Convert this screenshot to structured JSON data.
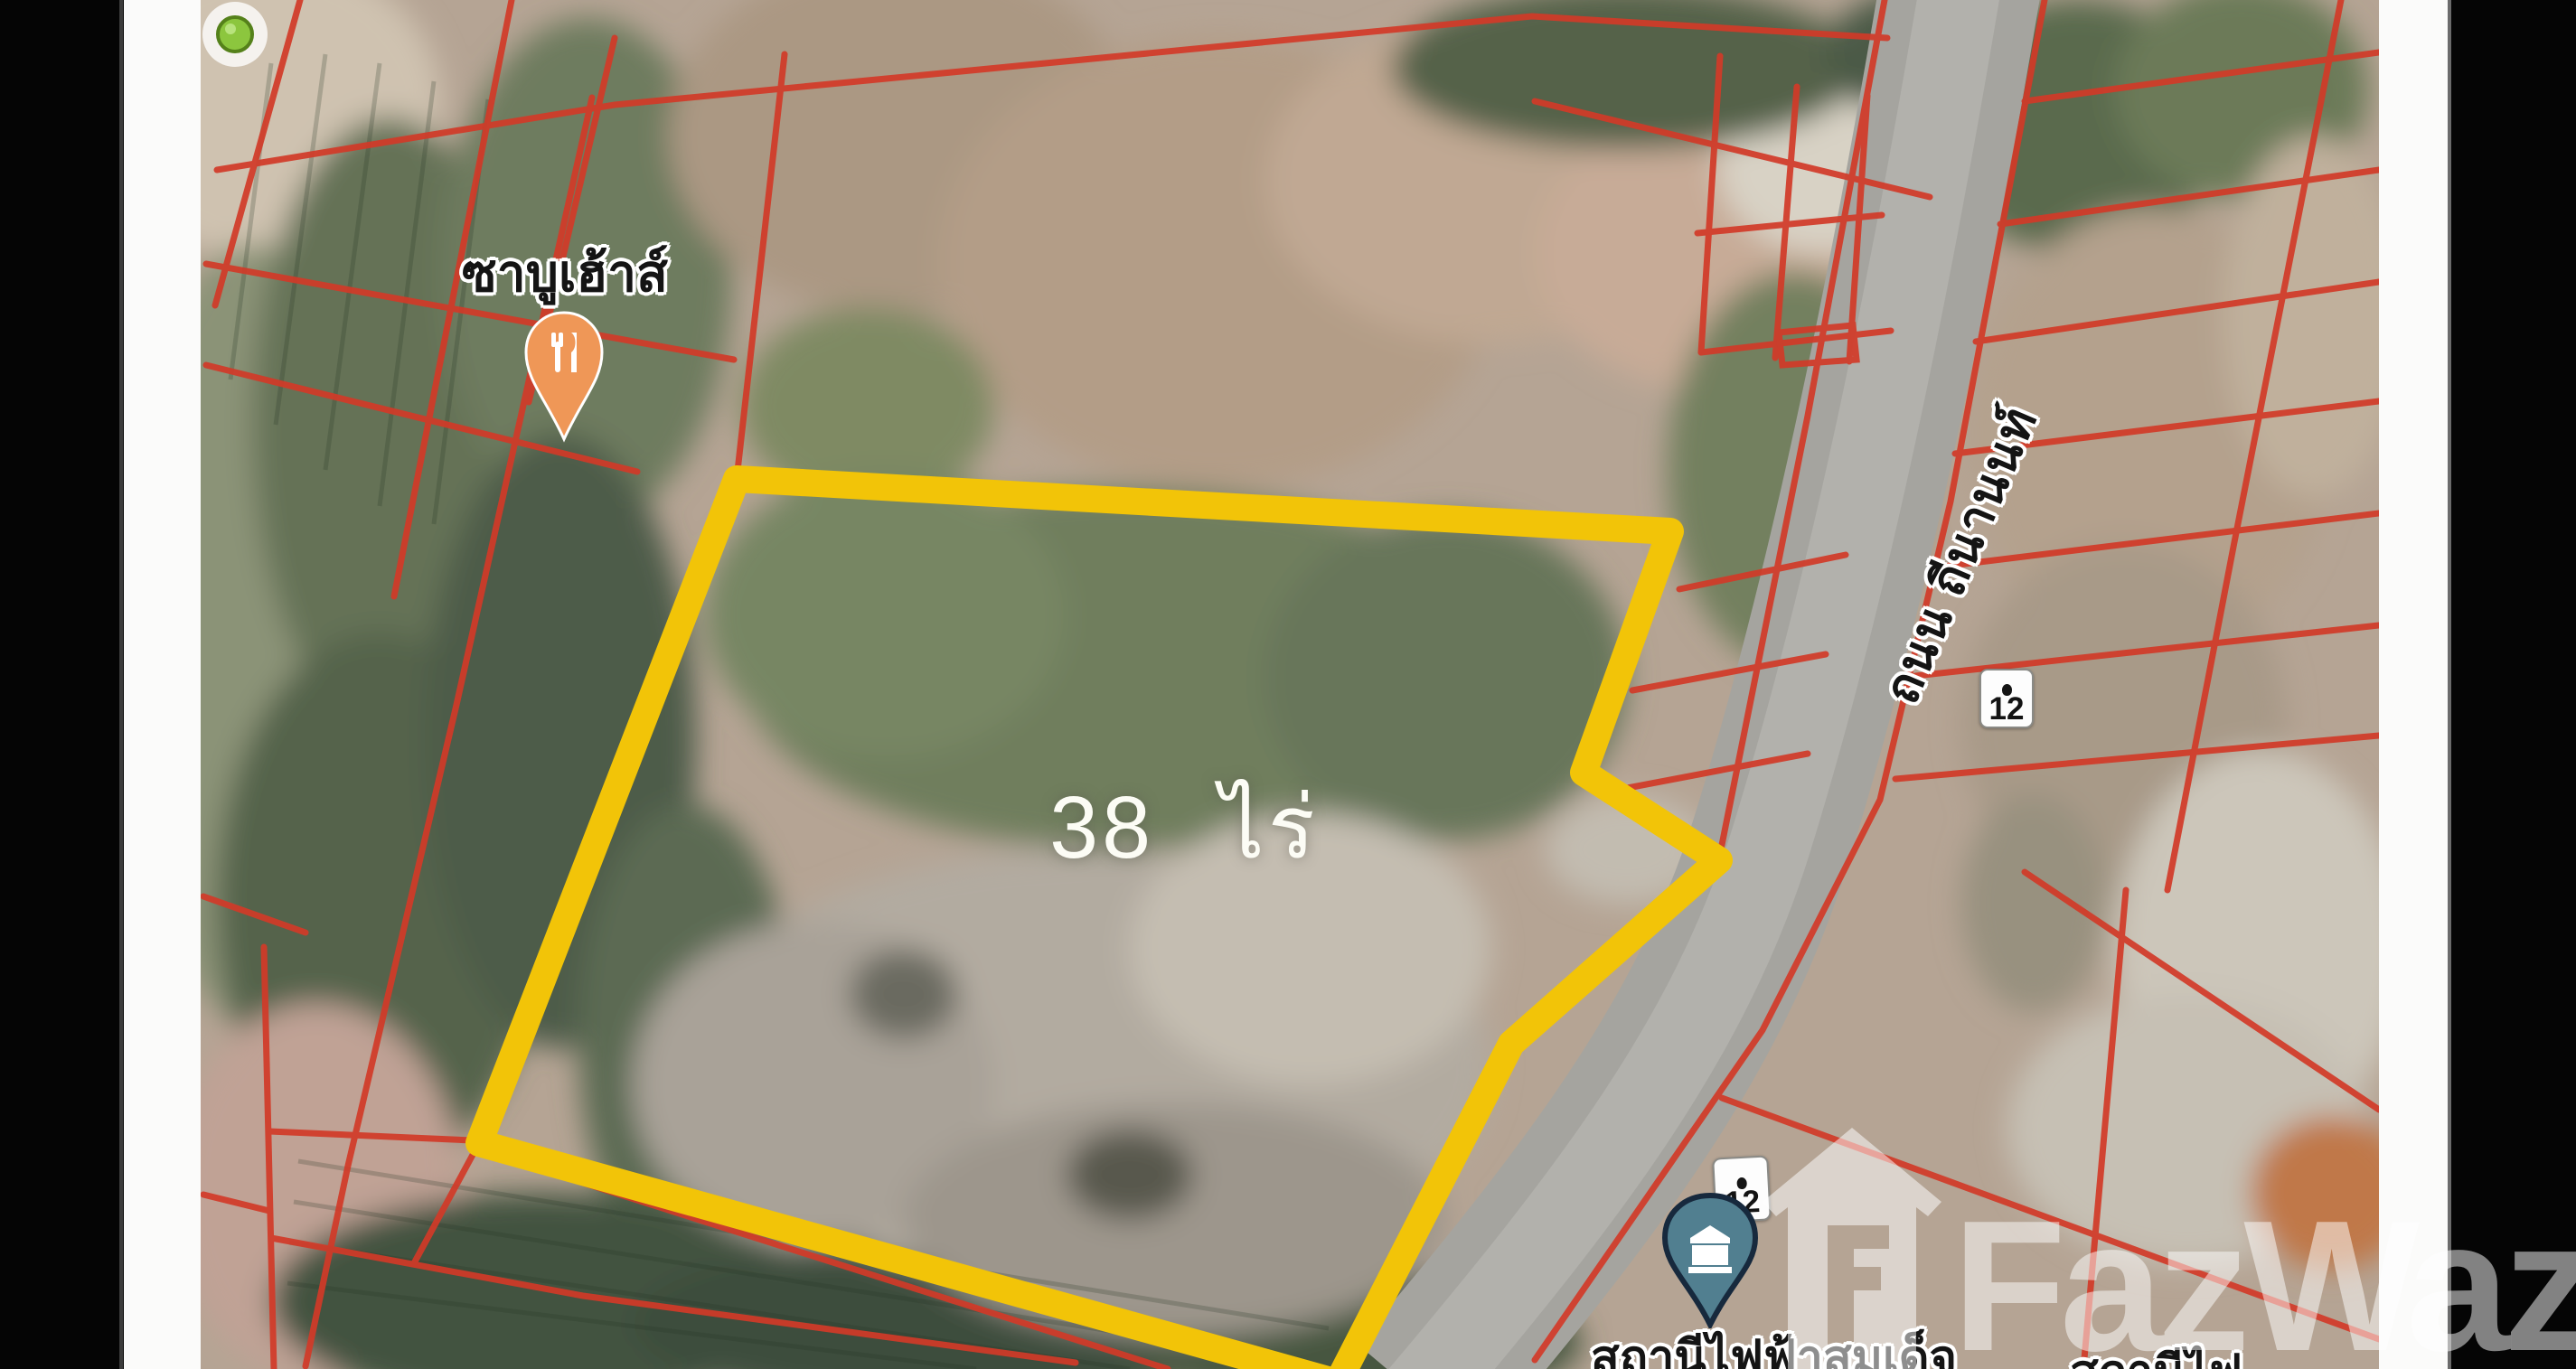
{
  "map_overlay": {
    "poi_restaurant": {
      "name": "ซาบูเฮ้าส์",
      "icon": "restaurant-pin"
    },
    "plot": {
      "area_label": "38 ไร่",
      "area_number": "38",
      "area_unit": "ไร่",
      "outline_color": "#F2C408",
      "marker_icon": "green-dot-marker"
    },
    "road": {
      "name": "ถนน ถีนานนท์",
      "route_number": "12"
    },
    "route_shields": [
      {
        "number": "12"
      },
      {
        "number": "12"
      }
    ],
    "poi_substation_left": {
      "name": "สถานีไฟฟ้าสมเด็จ",
      "icon": "building-pin"
    },
    "poi_substation_right": {
      "name": "สถานีไฟ"
    },
    "watermark": {
      "brand": "FazWaz",
      "icon": "house-logo"
    }
  },
  "colors": {
    "cadastral_line": "#D23A28",
    "plot_outline": "#F2C408",
    "road_surface": "#A5A49F",
    "letterbox": "#050505",
    "card": "#FBFBFA"
  }
}
